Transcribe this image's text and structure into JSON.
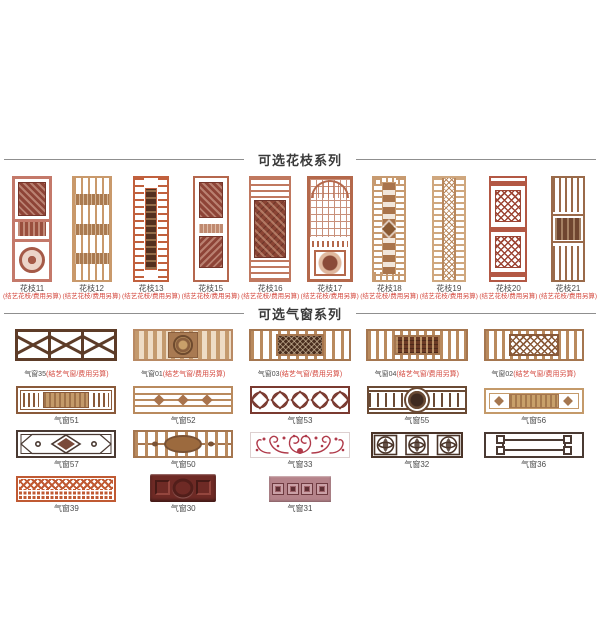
{
  "palette": {
    "note_red": "#d4493f",
    "title_text": "#3a3a3a",
    "label_text": "#4a4a4a",
    "divider": "#8f8f8f",
    "wood_light": "#c9996b",
    "wood_red": "#b5674d",
    "carved_dark": "#8e4437"
  },
  "flower_section": {
    "title": "可选花枝系列",
    "items": [
      {
        "label": "花枝11",
        "note": "(结艺花枝/费用另算)"
      },
      {
        "label": "花枝12",
        "note": "(结艺花枝/费用另算)"
      },
      {
        "label": "花枝13",
        "note": "(结艺花枝/费用另算)"
      },
      {
        "label": "花枝15",
        "note": "(结艺花枝/费用另算)"
      },
      {
        "label": "花枝16",
        "note": "(结艺花枝/费用另算)"
      },
      {
        "label": "花枝17",
        "note": "(结艺花枝/费用另算)"
      },
      {
        "label": "花枝18",
        "note": "(结艺花枝/费用另算)"
      },
      {
        "label": "花枝19",
        "note": "(结艺花枝/费用另算)"
      },
      {
        "label": "花枝20",
        "note": "(结艺花枝/费用另算)"
      },
      {
        "label": "花枝21",
        "note": "(结艺花枝/费用另算)"
      }
    ]
  },
  "transom_section": {
    "title": "可选气窗系列",
    "row1": [
      {
        "label": "气窗35",
        "note": "(结艺气窗/费用另算)"
      },
      {
        "label": "气窗01",
        "note": "(结艺气窗/费用另算)"
      },
      {
        "label": "气窗03",
        "note": "(结艺气窗/费用另算)"
      },
      {
        "label": "气窗04",
        "note": "(结艺气窗/费用另算)"
      },
      {
        "label": "气窗02",
        "note": "(结艺气窗/费用另算)"
      }
    ],
    "row2": [
      {
        "label": "气窗51"
      },
      {
        "label": "气窗52"
      },
      {
        "label": "气窗53"
      },
      {
        "label": "气窗55"
      },
      {
        "label": "气窗56"
      }
    ],
    "row3": [
      {
        "label": "气窗57"
      },
      {
        "label": "气窗50"
      },
      {
        "label": "气窗33"
      },
      {
        "label": "气窗32"
      },
      {
        "label": "气窗36"
      }
    ],
    "row4": [
      {
        "label": "气窗39"
      },
      {
        "label": "气窗30"
      },
      {
        "label": "气窗31"
      }
    ]
  }
}
